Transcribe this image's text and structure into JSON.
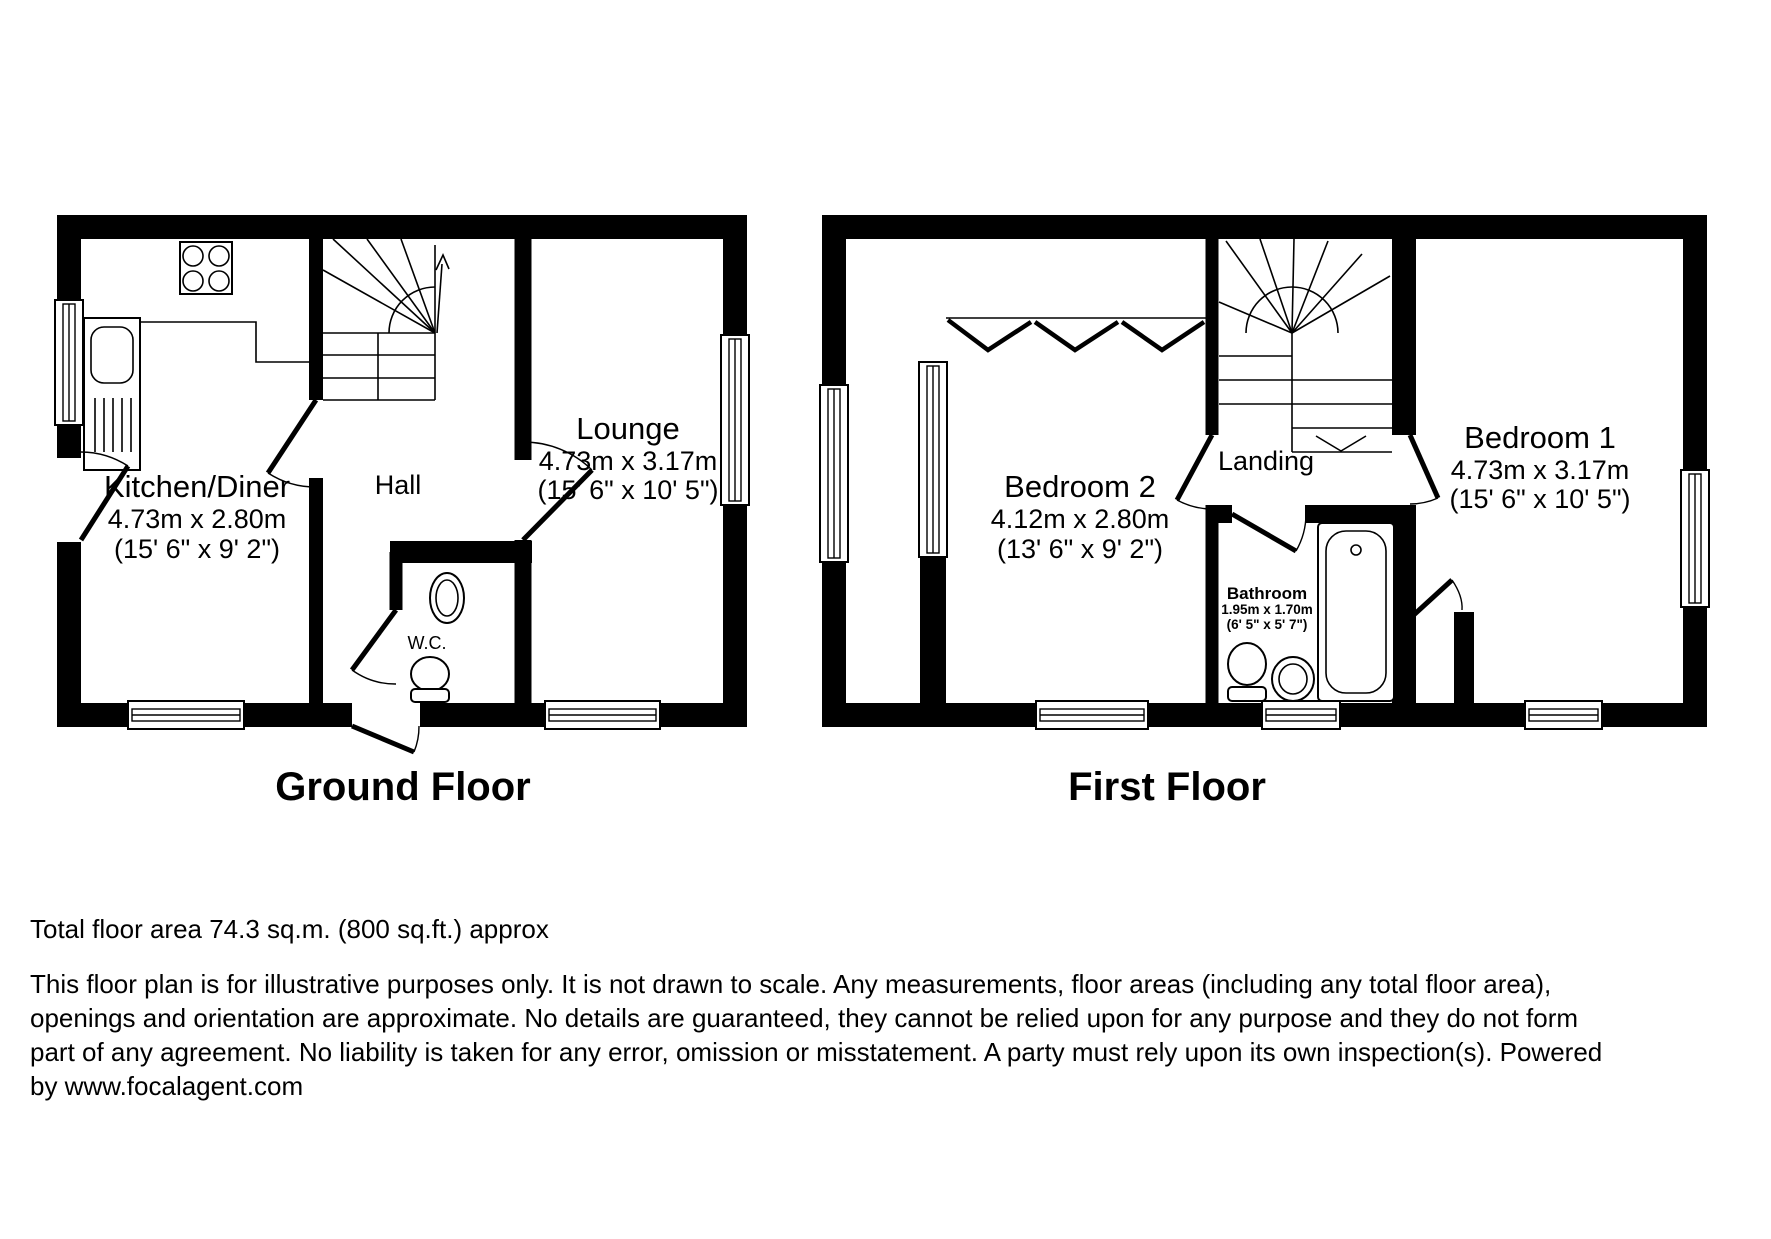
{
  "ground_floor": {
    "title": "Ground Floor",
    "kitchen": {
      "name": "Kitchen/Diner",
      "dim_metric": "4.73m x 2.80m",
      "dim_imperial": "(15' 6\" x 9' 2\")"
    },
    "hall": {
      "name": "Hall"
    },
    "lounge": {
      "name": "Lounge",
      "dim_metric": "4.73m x 3.17m",
      "dim_imperial": "(15' 6\" x 10' 5\")"
    },
    "wc": {
      "name": "W.C."
    }
  },
  "first_floor": {
    "title": "First Floor",
    "bedroom2": {
      "name": "Bedroom 2",
      "dim_metric": "4.12m x 2.80m",
      "dim_imperial": "(13' 6\" x 9' 2\")"
    },
    "landing": {
      "name": "Landing"
    },
    "bathroom": {
      "name": "Bathroom",
      "dim_metric": "1.95m x 1.70m",
      "dim_imperial": "(6' 5\" x 5' 7\")"
    },
    "bedroom1": {
      "name": "Bedroom 1",
      "dim_metric": "4.73m x 3.17m",
      "dim_imperial": "(15' 6\" x 10' 5\")"
    }
  },
  "footer": {
    "total_area": "Total floor area 74.3 sq.m. (800 sq.ft.) approx",
    "disclaimer_lines": [
      "This floor plan is for illustrative purposes only. It is not drawn to scale. Any measurements, floor areas (including any total floor area),",
      "openings and orientation are approximate. No details are guaranteed, they cannot be relied upon for any purpose and they do not form",
      "part of any agreement. No liability is taken for any error, omission or misstatement. A party must rely upon its own inspection(s). Powered",
      "by www.focalagent.com"
    ]
  },
  "colors": {
    "wall": "#000000",
    "background": "#ffffff"
  }
}
